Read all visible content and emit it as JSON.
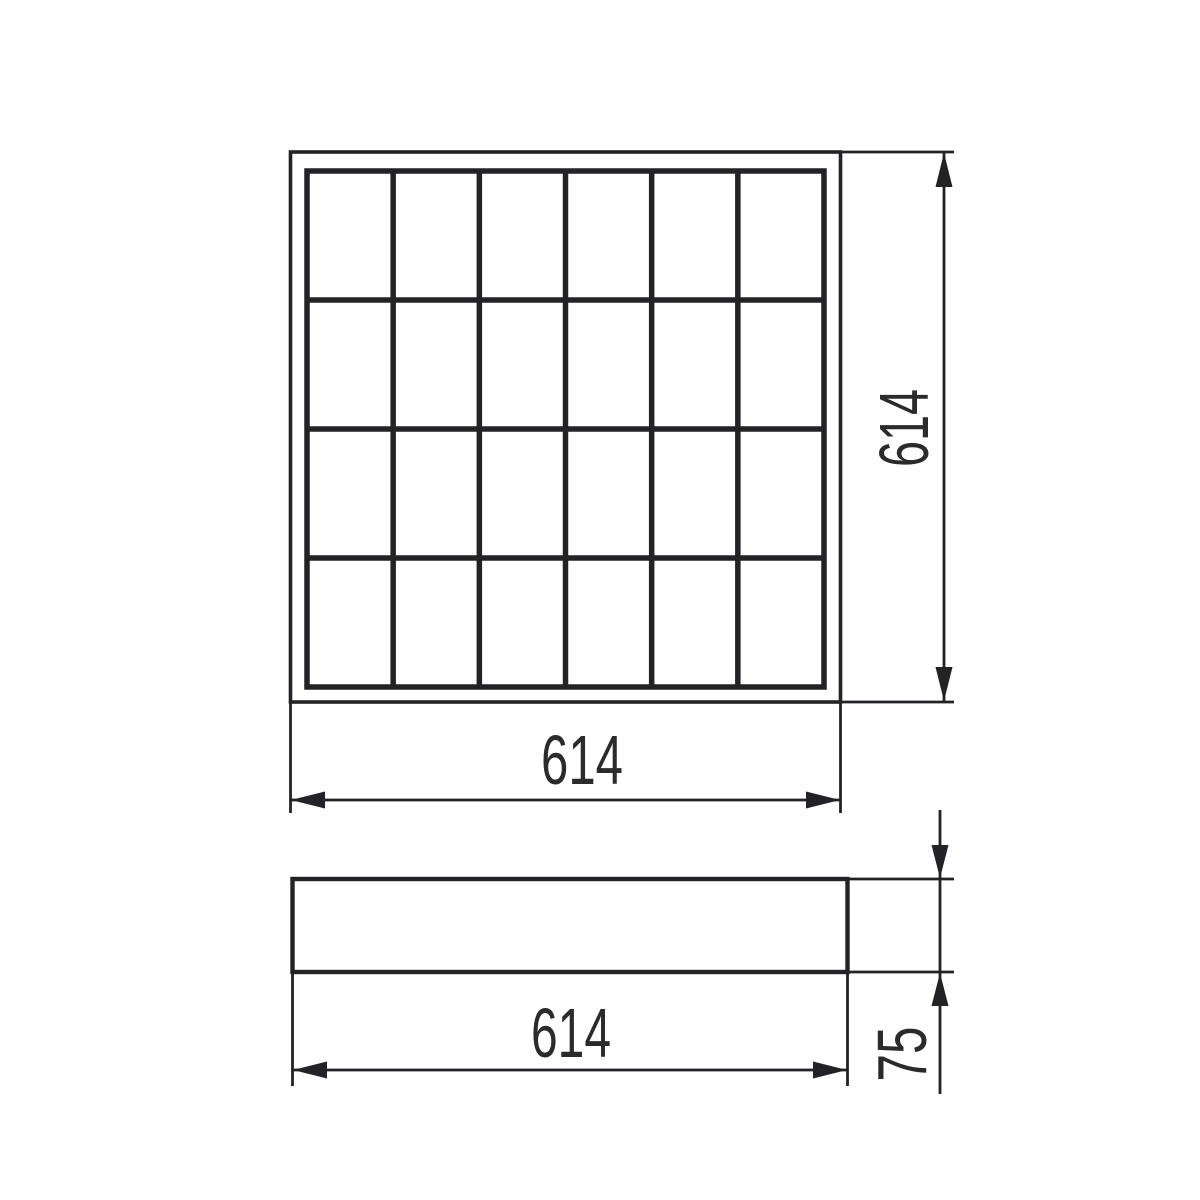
{
  "drawing": {
    "background_color": "#ffffff",
    "line_color": "#232226",
    "text_color": "#2b2b2b",
    "views": {
      "top_view": {
        "grid_columns": 6,
        "grid_rows": 4,
        "width_label": "614",
        "height_label": "614"
      },
      "side_view": {
        "width_label": "614",
        "height_label": "75"
      }
    }
  }
}
